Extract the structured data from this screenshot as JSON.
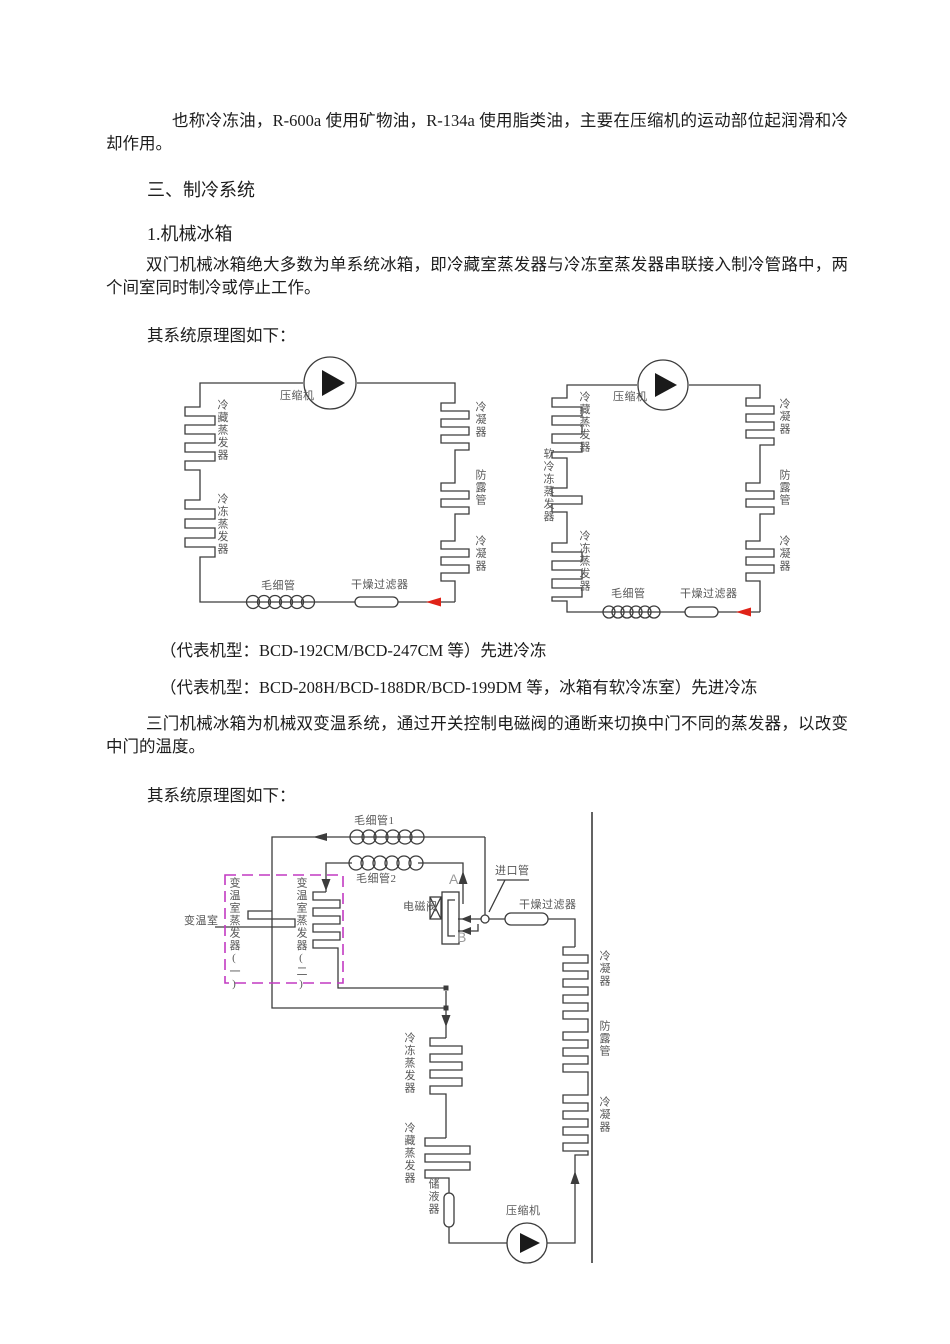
{
  "page": {
    "p1": "也称冷冻油，R-600a 使用矿物油，R-134a 使用脂类油，主要在压缩机的运动部位起润滑和冷却作用。",
    "h_section": "三、制冷系统",
    "h_sub": "1.机械冰箱",
    "p2": "双门机械冰箱绝大多数为单系统冰箱，即冷藏室蒸发器与冷冻室蒸发器串联接入制冷管路中，两个间室同时制冷或停止工作。",
    "p3": "其系统原理图如下：",
    "caption1": "（代表机型：BCD-192CM/BCD-247CM 等）先进冷冻",
    "caption2": "（代表机型：BCD-208H/BCD-188DR/BCD-199DM 等，冰箱有软冷冻室）先进冷冻",
    "p4": "三门机械冰箱为机械双变温系统，通过开关控制电磁阀的通断来切换中门不同的蒸发器，以改变中门的温度。",
    "p5": "其系统原理图如下："
  },
  "diagram1": {
    "compressor": "压缩机",
    "evap_fridge": "冷藏蒸发器",
    "evap_freezer": "冷冻蒸发器",
    "condenser_top": "冷凝器",
    "anti_dew_pipe": "防露管",
    "condenser_bottom": "冷凝器",
    "capillary": "毛细管",
    "dry_filter": "干燥过滤器"
  },
  "diagram2": {
    "compressor": "压缩机",
    "evap_fridge": "冷藏蒸发器",
    "evap_soft_freezer": "软冷冻蒸发器",
    "evap_freezer": "冷冻蒸发器",
    "condenser_top": "冷凝器",
    "anti_dew_pipe": "防露管",
    "condenser_bottom": "冷凝器",
    "capillary": "毛细管",
    "dry_filter": "干燥过滤器"
  },
  "diagram3": {
    "capillary1": "毛细管1",
    "capillary2": "毛细管2",
    "var_room": "变温室",
    "evap_var_1": "变温室蒸发器(一)",
    "evap_var_2": "变温室蒸发器(二)",
    "solenoid_valve": "电磁阀",
    "port_a": "A",
    "port_b": "B",
    "inlet_pipe": "进口管",
    "dry_filter": "干燥过滤器",
    "condenser_top": "冷凝器",
    "anti_dew_pipe": "防露管",
    "condenser_bottom": "冷凝器",
    "evap_freezer": "冷冻蒸发器",
    "evap_fridge": "冷藏蒸发器",
    "accumulator": "储液器",
    "compressor": "压缩机"
  },
  "colors": {
    "line": "#3c3c3c",
    "label": "#575757",
    "accent_box": "#c23ac2",
    "flow_arrow": "#e02318"
  }
}
